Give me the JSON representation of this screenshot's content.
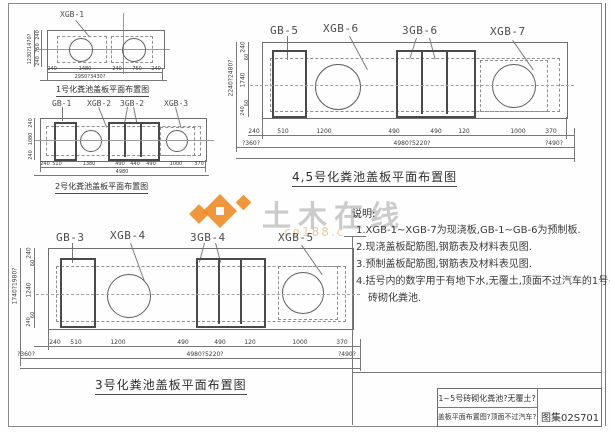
{
  "watermark": {
    "brand": "土木在线",
    "sub": "co188.c"
  },
  "notes": {
    "heading": "说明:",
    "item1": "1.XGB-1~XGB-7为现浇板,GB-1~GB-6为预制板.",
    "item2": "2.现浇盖板配筋图,钢筋表及材料表见图.",
    "item3": "3.预制盖板配筋图,钢筋表及材料表见图.",
    "item4": "4.括号内的数字用于有地下水,无覆土,顶面不过汽车的1号~5号",
    "item4b": "砖砌化粪池."
  },
  "titleblock": {
    "line1": "1~5号砖砌化粪池?无覆土?",
    "line2": "盖板平面布置图?顶面不过汽车?",
    "atlas": "图集02S701"
  },
  "d1": {
    "label": "XGB-1",
    "caption": "1号化粪池盖板平面布置图",
    "left": [
      "240",
      "750",
      "240"
    ],
    "left_total": "1230?1470?",
    "bottom": [
      "240",
      "1480",
      "240",
      "750",
      "240"
    ],
    "bottom_total": "2950?3430?"
  },
  "d2": {
    "labels": [
      "GB-1",
      "XGB-2",
      "3GB-2",
      "XGB-3"
    ],
    "caption": "2号化粪池盖板平面布置图",
    "left": [
      "240",
      "1080",
      "240"
    ],
    "bottom": [
      "240",
      "510",
      "1380",
      "490",
      "440",
      "490",
      "1000",
      "370"
    ],
    "bottom_total": "4980"
  },
  "d45": {
    "labels": [
      "GB-5",
      "XGB-6",
      "3GB-6",
      "XGB-7"
    ],
    "caption": "4,5号化粪池盖板平面布置图",
    "left": [
      "240",
      "60",
      "1740",
      "60",
      "240"
    ],
    "left_total": "2240?2480?",
    "row1": [
      "240",
      "510",
      "1200",
      "490",
      "490",
      "120",
      "1000",
      "370"
    ],
    "row2": [
      "?360?",
      "4980?5220?",
      "?490?"
    ]
  },
  "d3": {
    "labels": [
      "GB-3",
      "XGB-4",
      "3GB-4",
      "XGB-5"
    ],
    "caption": "3号化粪池盖板平面布置图",
    "left": [
      "240",
      "60",
      "1240",
      "60",
      "240"
    ],
    "left_total": "1740?1980?",
    "row1": [
      "240",
      "510",
      "1200",
      "490",
      "490",
      "120",
      "1000",
      "370"
    ],
    "row2": [
      "?360?",
      "4980?5220?",
      "?490?"
    ]
  }
}
